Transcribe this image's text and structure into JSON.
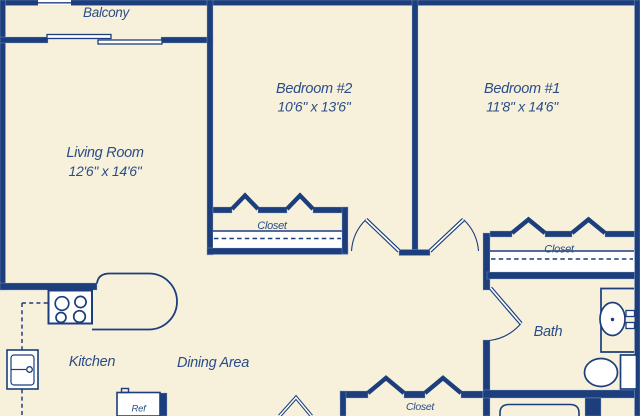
{
  "colors": {
    "background": "#f7f0db",
    "wall": "#1c3e7c",
    "text": "#2b4d87"
  },
  "rooms": {
    "balcony": {
      "label": "Balcony"
    },
    "living_room": {
      "label": "Living Room",
      "dimensions": "12'6\" x 14'6\""
    },
    "bedroom_2": {
      "label": "Bedroom #2",
      "dimensions": "10'6\" x 13'6\""
    },
    "bedroom_1": {
      "label": "Bedroom #1",
      "dimensions": "11'8\" x 14'6\""
    },
    "kitchen": {
      "label": "Kitchen"
    },
    "dining_area": {
      "label": "Dining Area"
    },
    "bath": {
      "label": "Bath"
    },
    "closet_bedroom_2": {
      "label": "Closet"
    },
    "closet_bedroom_1": {
      "label": "Closet"
    },
    "closet_hall": {
      "label": "Closet"
    }
  },
  "fixtures": {
    "refrigerator": {
      "label": "Ref"
    }
  }
}
